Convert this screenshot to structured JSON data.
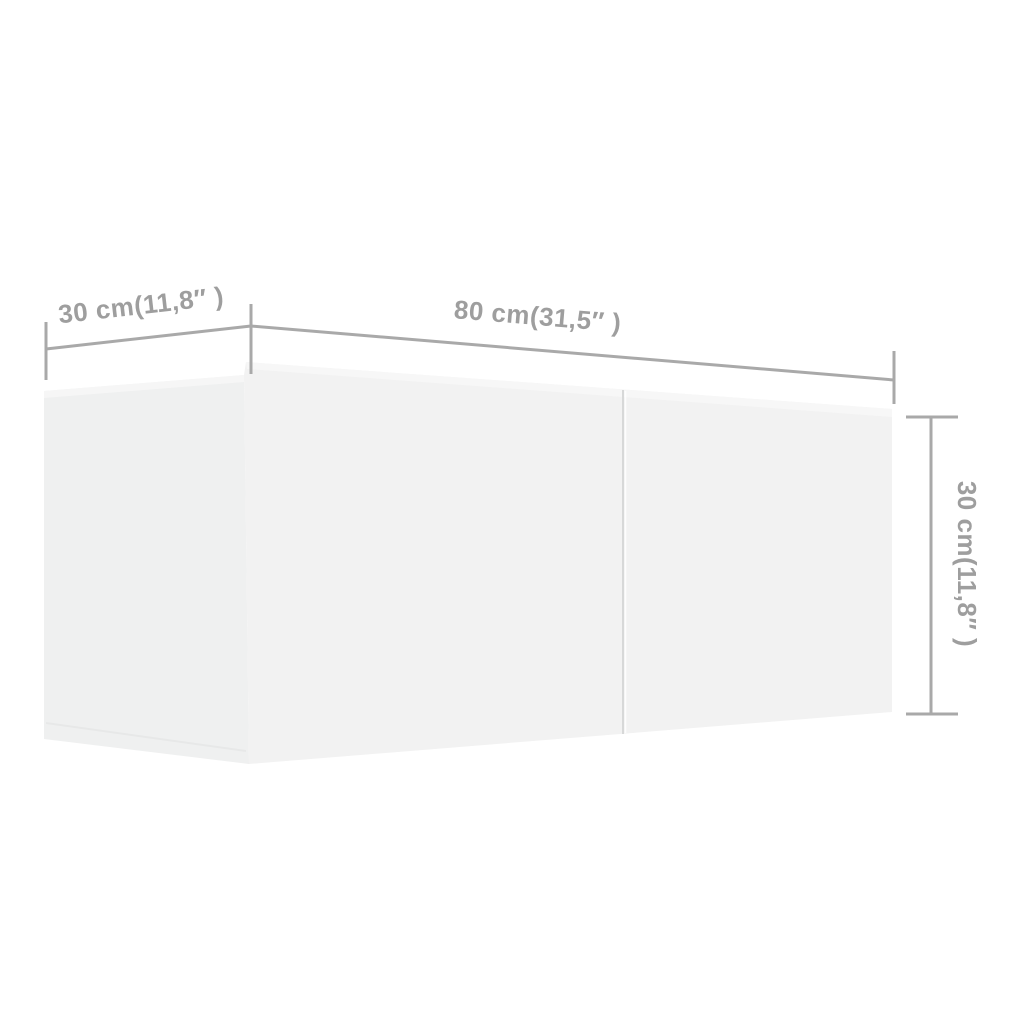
{
  "colors": {
    "background": "#ffffff",
    "side-face": "#eff0f0",
    "front-face": "#f2f2f2",
    "top-bevel": "#f8f8f8",
    "seam": "#d7d8d8",
    "crease": "#e7e8e8",
    "dimension-line": "#a9a9a9",
    "dimension-text": "#9e9e9e"
  },
  "diagram": {
    "kind": "product-dimension-diagram",
    "object": "wall-mounted tv cabinet",
    "dimensions": {
      "depth": {
        "label": "30 cm(11,8″ )",
        "cm": 30,
        "inches": "11,8"
      },
      "width": {
        "label": "80 cm(31,5″ )",
        "cm": 80,
        "inches": "31,5"
      },
      "height": {
        "label": "30 cm(11,8″ )",
        "cm": 30,
        "inches": "11,8"
      }
    }
  }
}
